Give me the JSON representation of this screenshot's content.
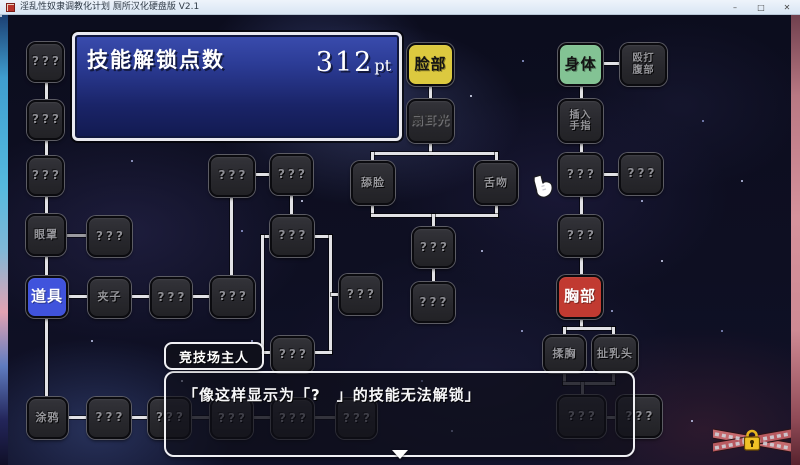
{
  "window": {
    "title": "淫乱性奴隶调教化计划 厕所汉化硬盘版 V2.1",
    "minimize_glyph": "–",
    "maximize_glyph": "□",
    "close_glyph": "✕"
  },
  "panel": {
    "title": "技能解锁点数",
    "points_value": "312",
    "points_unit": "pt"
  },
  "dialog": {
    "speaker": "竞技场主人",
    "text": "「像这样显示为「?　」的技能无法解锁」"
  },
  "colors": {
    "accent_blue": "#4053dc",
    "category_yellow": "#dcc93f",
    "category_green": "#83c394",
    "category_red": "#c13a31",
    "node_silver": "#b4b4b6",
    "line_bright": "#e2e2e6",
    "line_dim": "#6e6e76"
  },
  "tree": {
    "nodes": [
      {
        "id": "unknown-l1",
        "label": "???",
        "type": "unknown",
        "x": 27,
        "y": 42,
        "w": 37,
        "h": 40
      },
      {
        "id": "unknown-l2",
        "label": "???",
        "type": "unknown",
        "x": 27,
        "y": 100,
        "w": 37,
        "h": 40
      },
      {
        "id": "unknown-l3",
        "label": "???",
        "type": "unknown",
        "x": 27,
        "y": 156,
        "w": 37,
        "h": 40
      },
      {
        "id": "blindfold",
        "label": "眼罩",
        "type": "locked",
        "x": 26,
        "y": 214,
        "w": 40,
        "h": 42
      },
      {
        "id": "items",
        "label": "道具",
        "type": "category selected",
        "color": "#4053dc",
        "text_color": "#ffffff",
        "x": 26,
        "y": 276,
        "w": 42,
        "h": 42
      },
      {
        "id": "doodle",
        "label": "涂鸦",
        "type": "locked",
        "x": 27,
        "y": 397,
        "w": 41,
        "h": 42
      },
      {
        "id": "unknown-m1",
        "label": "???",
        "type": "unknown",
        "x": 87,
        "y": 216,
        "w": 45,
        "h": 41
      },
      {
        "id": "clamps",
        "label": "夹子",
        "type": "locked",
        "x": 88,
        "y": 277,
        "w": 43,
        "h": 41
      },
      {
        "id": "unknown-m3",
        "label": "???",
        "type": "unknown",
        "x": 150,
        "y": 277,
        "w": 42,
        "h": 41
      },
      {
        "id": "unknown-m4",
        "label": "???",
        "type": "unknown",
        "x": 210,
        "y": 276,
        "w": 45,
        "h": 42
      },
      {
        "id": "unknown-m5",
        "label": "???",
        "type": "unknown",
        "x": 209,
        "y": 155,
        "w": 46,
        "h": 42
      },
      {
        "id": "unknown-m6",
        "label": "???",
        "type": "unknown",
        "x": 270,
        "y": 154,
        "w": 43,
        "h": 41
      },
      {
        "id": "unknown-m7",
        "label": "???",
        "type": "unknown",
        "x": 270,
        "y": 215,
        "w": 44,
        "h": 42
      },
      {
        "id": "unknown-m8",
        "label": "???",
        "type": "unknown",
        "x": 339,
        "y": 274,
        "w": 43,
        "h": 41
      },
      {
        "id": "unknown-m9",
        "label": "???",
        "type": "unknown",
        "x": 271,
        "y": 336,
        "w": 43,
        "h": 37
      },
      {
        "id": "lick-face",
        "label": "舔脸",
        "type": "locked",
        "x": 351,
        "y": 161,
        "w": 44,
        "h": 44
      },
      {
        "id": "tongue-kiss",
        "label": "舌吻",
        "type": "locked",
        "x": 474,
        "y": 161,
        "w": 44,
        "h": 44
      },
      {
        "id": "unknown-c1",
        "label": "???",
        "type": "unknown",
        "x": 412,
        "y": 227,
        "w": 43,
        "h": 41
      },
      {
        "id": "unknown-c2",
        "label": "???",
        "type": "unknown",
        "x": 411,
        "y": 282,
        "w": 44,
        "h": 41
      },
      {
        "id": "face",
        "label": "脸部",
        "type": "category",
        "color": "#dcc93f",
        "text_color": "#141414",
        "x": 407,
        "y": 43,
        "w": 47,
        "h": 43
      },
      {
        "id": "slap-face",
        "label": "扇耳光",
        "type": "locked silver",
        "text_color": "#2c2c2e",
        "x": 407,
        "y": 99,
        "w": 47,
        "h": 44
      },
      {
        "id": "body",
        "label": "身体",
        "type": "category",
        "color": "#83c394",
        "text_color": "#141414",
        "x": 558,
        "y": 43,
        "w": 45,
        "h": 43
      },
      {
        "id": "insert-finger",
        "label": "插入\n手指",
        "type": "locked two",
        "x": 558,
        "y": 99,
        "w": 45,
        "h": 44
      },
      {
        "id": "punch-belly",
        "label": "殴打\n腹部",
        "type": "locked two",
        "x": 620,
        "y": 43,
        "w": 47,
        "h": 43
      },
      {
        "id": "unknown-r1",
        "label": "???",
        "type": "unknown",
        "x": 558,
        "y": 153,
        "w": 45,
        "h": 43
      },
      {
        "id": "unknown-r2",
        "label": "???",
        "type": "unknown",
        "x": 619,
        "y": 153,
        "w": 44,
        "h": 42
      },
      {
        "id": "unknown-r3",
        "label": "???",
        "type": "unknown",
        "x": 558,
        "y": 215,
        "w": 45,
        "h": 42
      },
      {
        "id": "breast",
        "label": "胸部",
        "type": "category",
        "color": "#c13a31",
        "text_color": "#ffffff",
        "x": 557,
        "y": 275,
        "w": 46,
        "h": 44
      },
      {
        "id": "rub-breast",
        "label": "揉胸",
        "type": "locked",
        "x": 543,
        "y": 335,
        "w": 43,
        "h": 38
      },
      {
        "id": "pull-nipple",
        "label": "扯乳头",
        "type": "locked",
        "x": 592,
        "y": 335,
        "w": 46,
        "h": 38
      },
      {
        "id": "unknown-b1",
        "label": "???",
        "type": "unknown",
        "x": 87,
        "y": 397,
        "w": 44,
        "h": 42
      },
      {
        "id": "unknown-b2",
        "label": "???",
        "type": "unknown",
        "x": 148,
        "y": 397,
        "w": 43,
        "h": 42
      },
      {
        "id": "unknown-b3",
        "label": "???",
        "type": "unknown",
        "x": 210,
        "y": 398,
        "w": 43,
        "h": 41
      },
      {
        "id": "unknown-b4",
        "label": "???",
        "type": "unknown",
        "x": 271,
        "y": 398,
        "w": 43,
        "h": 41
      },
      {
        "id": "unknown-b5",
        "label": "???",
        "type": "unknown",
        "x": 336,
        "y": 398,
        "w": 41,
        "h": 41
      },
      {
        "id": "unknown-b6",
        "label": "???",
        "type": "unknown",
        "x": 557,
        "y": 395,
        "w": 49,
        "h": 43
      },
      {
        "id": "unknown-b7",
        "label": "???",
        "type": "unknown",
        "x": 616,
        "y": 395,
        "w": 46,
        "h": 43
      }
    ],
    "connectors": [
      {
        "x": 45,
        "y": 82,
        "w": 3,
        "h": 20,
        "tone": "bright"
      },
      {
        "x": 45,
        "y": 140,
        "w": 3,
        "h": 18,
        "tone": "bright"
      },
      {
        "x": 45,
        "y": 196,
        "w": 3,
        "h": 20,
        "tone": "bright"
      },
      {
        "x": 45,
        "y": 256,
        "w": 3,
        "h": 21,
        "tone": "bright"
      },
      {
        "x": 45,
        "y": 317,
        "w": 3,
        "h": 81,
        "tone": "bright"
      },
      {
        "x": 66,
        "y": 234,
        "w": 23,
        "h": 3,
        "tone": "mid"
      },
      {
        "x": 67,
        "y": 295,
        "w": 23,
        "h": 3,
        "tone": "bright"
      },
      {
        "x": 131,
        "y": 295,
        "w": 20,
        "h": 3,
        "tone": "bright"
      },
      {
        "x": 192,
        "y": 295,
        "w": 20,
        "h": 3,
        "tone": "bright"
      },
      {
        "x": 66,
        "y": 416,
        "w": 23,
        "h": 3,
        "tone": "bright"
      },
      {
        "x": 130,
        "y": 416,
        "w": 19,
        "h": 3,
        "tone": "bright"
      },
      {
        "x": 189,
        "y": 416,
        "w": 23,
        "h": 3,
        "tone": "dim"
      },
      {
        "x": 252,
        "y": 416,
        "w": 21,
        "h": 3,
        "tone": "dim"
      },
      {
        "x": 313,
        "y": 416,
        "w": 25,
        "h": 3,
        "tone": "dim"
      },
      {
        "x": 254,
        "y": 173,
        "w": 18,
        "h": 3,
        "tone": "bright"
      },
      {
        "x": 230,
        "y": 196,
        "w": 3,
        "h": 82,
        "tone": "bright"
      },
      {
        "x": 290,
        "y": 194,
        "w": 3,
        "h": 23,
        "tone": "bright"
      },
      {
        "x": 261,
        "y": 235,
        "w": 12,
        "h": 3,
        "tone": "bright"
      },
      {
        "x": 261,
        "y": 235,
        "w": 3,
        "h": 119,
        "tone": "bright"
      },
      {
        "x": 261,
        "y": 351,
        "w": 12,
        "h": 3,
        "tone": "bright"
      },
      {
        "x": 313,
        "y": 235,
        "w": 19,
        "h": 3,
        "tone": "bright"
      },
      {
        "x": 329,
        "y": 235,
        "w": 3,
        "h": 119,
        "tone": "bright"
      },
      {
        "x": 331,
        "y": 293,
        "w": 10,
        "h": 3,
        "tone": "bright"
      },
      {
        "x": 313,
        "y": 351,
        "w": 19,
        "h": 3,
        "tone": "bright"
      },
      {
        "x": 429,
        "y": 85,
        "w": 3,
        "h": 16,
        "tone": "bright"
      },
      {
        "x": 429,
        "y": 142,
        "w": 3,
        "h": 13,
        "tone": "bright"
      },
      {
        "x": 371,
        "y": 152,
        "w": 127,
        "h": 3,
        "tone": "bright"
      },
      {
        "x": 371,
        "y": 152,
        "w": 3,
        "h": 11,
        "tone": "bright"
      },
      {
        "x": 495,
        "y": 152,
        "w": 3,
        "h": 11,
        "tone": "bright"
      },
      {
        "x": 371,
        "y": 204,
        "w": 3,
        "h": 13,
        "tone": "bright"
      },
      {
        "x": 495,
        "y": 204,
        "w": 3,
        "h": 13,
        "tone": "bright"
      },
      {
        "x": 371,
        "y": 214,
        "w": 127,
        "h": 3,
        "tone": "bright"
      },
      {
        "x": 432,
        "y": 214,
        "w": 3,
        "h": 14,
        "tone": "bright"
      },
      {
        "x": 432,
        "y": 267,
        "w": 3,
        "h": 16,
        "tone": "bright"
      },
      {
        "x": 580,
        "y": 85,
        "w": 3,
        "h": 16,
        "tone": "bright"
      },
      {
        "x": 602,
        "y": 62,
        "w": 20,
        "h": 3,
        "tone": "bright"
      },
      {
        "x": 580,
        "y": 142,
        "w": 3,
        "h": 13,
        "tone": "bright"
      },
      {
        "x": 602,
        "y": 173,
        "w": 19,
        "h": 3,
        "tone": "bright"
      },
      {
        "x": 580,
        "y": 196,
        "w": 3,
        "h": 21,
        "tone": "bright"
      },
      {
        "x": 580,
        "y": 257,
        "w": 3,
        "h": 20,
        "tone": "bright"
      },
      {
        "x": 580,
        "y": 318,
        "w": 3,
        "h": 12,
        "tone": "bright"
      },
      {
        "x": 563,
        "y": 327,
        "w": 52,
        "h": 3,
        "tone": "bright"
      },
      {
        "x": 563,
        "y": 327,
        "w": 3,
        "h": 10,
        "tone": "bright"
      },
      {
        "x": 612,
        "y": 327,
        "w": 3,
        "h": 10,
        "tone": "bright"
      },
      {
        "x": 563,
        "y": 372,
        "w": 3,
        "h": 13,
        "tone": "dim"
      },
      {
        "x": 612,
        "y": 372,
        "w": 3,
        "h": 13,
        "tone": "dim"
      },
      {
        "x": 563,
        "y": 382,
        "w": 52,
        "h": 3,
        "tone": "dim"
      },
      {
        "x": 581,
        "y": 382,
        "w": 3,
        "h": 15,
        "tone": "dim"
      },
      {
        "x": 605,
        "y": 416,
        "w": 13,
        "h": 3,
        "tone": "dim"
      }
    ]
  },
  "icons": {
    "hand_cursor": "hand-pointer",
    "chest": "chained-locked-chest",
    "continue_indicator": "down-triangle"
  }
}
